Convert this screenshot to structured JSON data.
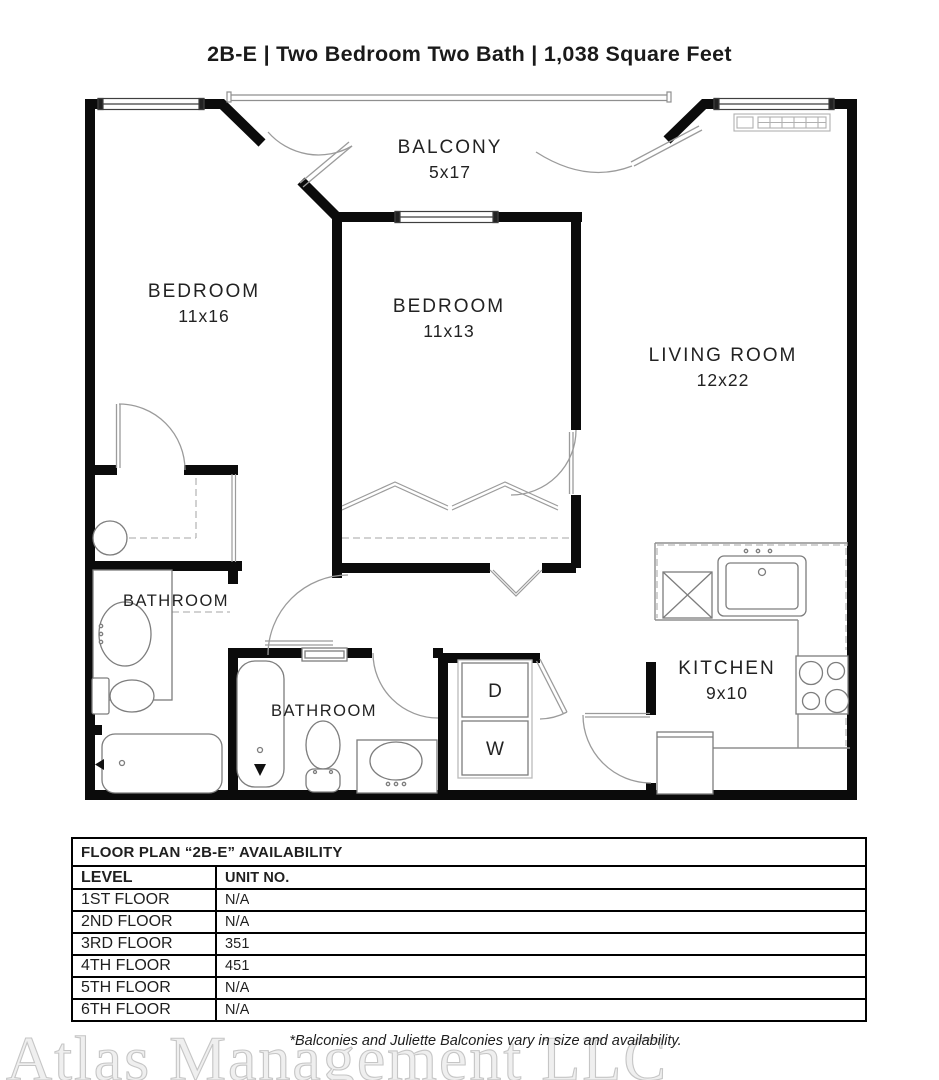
{
  "page": {
    "title": "2B-E | Two Bedroom Two Bath | 1,038 Square Feet"
  },
  "floor_plan": {
    "balcony": {
      "label": "BALCONY",
      "dims": "5x17"
    },
    "bedroom_left": {
      "label": "BEDROOM",
      "dims": "11x16"
    },
    "bedroom_middle": {
      "label": "BEDROOM",
      "dims": "11x13"
    },
    "living_room": {
      "label": "LIVING ROOM",
      "dims": "12x22"
    },
    "bathroom_left": {
      "label": "BATHROOM"
    },
    "bathroom_middle": {
      "label": "BATHROOM"
    },
    "kitchen": {
      "label": "KITCHEN",
      "dims": "9x10"
    },
    "dryer_label": "D",
    "washer_label": "W"
  },
  "availability": {
    "title": "FLOOR PLAN “2B-E” AVAILABILITY",
    "columns": [
      "LEVEL",
      "UNIT NO."
    ],
    "rows": [
      {
        "level": "1ST FLOOR",
        "unit": "N/A"
      },
      {
        "level": "2ND FLOOR",
        "unit": "N/A"
      },
      {
        "level": "3RD FLOOR",
        "unit": "351"
      },
      {
        "level": "4TH FLOOR",
        "unit": "451"
      },
      {
        "level": "5TH FLOOR",
        "unit": "N/A"
      },
      {
        "level": "6TH FLOOR",
        "unit": "N/A"
      }
    ]
  },
  "footer": {
    "watermark": "Atlas Management LLC",
    "note": "*Balconies and Juliette Balconies vary in size and availability."
  },
  "colors": {
    "wall": "#0b0b0b",
    "thin_line": "#8f8f8f",
    "text": "#1f1f1f",
    "watermark_fill": "#efefef",
    "watermark_stroke": "#c6c6c6"
  }
}
